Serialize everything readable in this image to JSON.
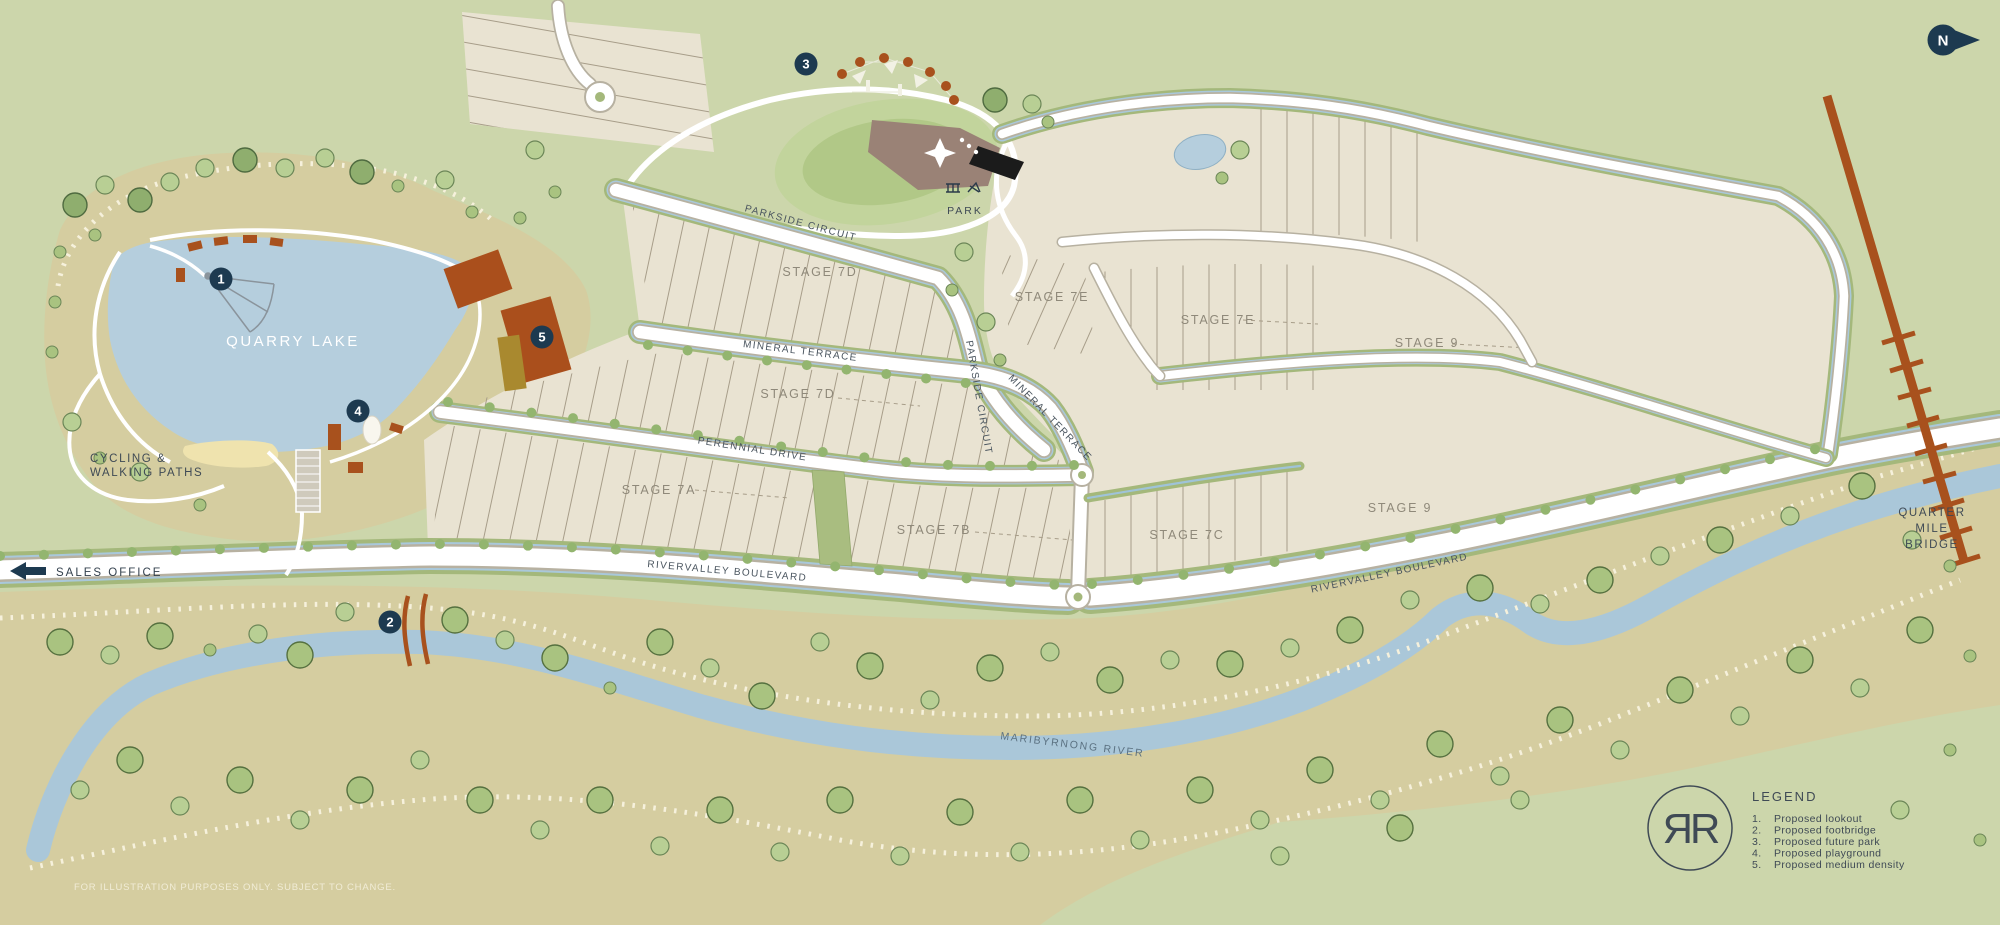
{
  "colors": {
    "background": "#ccd6ab",
    "river_corridor": "#d5cda0",
    "lot_fill": "#e9e3d2",
    "road_white": "#ffffff",
    "road_casing": "#b7b1a1",
    "verge_green": "#a4b87b",
    "water_blue": "#b5cedd",
    "river_blue": "#aac7d9",
    "tree_green": "#a9c380",
    "rust_brown": "#a8511d",
    "marker_navy": "#1d3a50",
    "stage_text": "#8f897a",
    "dark_text": "#3f4a55"
  },
  "north": {
    "label": "N"
  },
  "sales": {
    "label": "SALES OFFICE"
  },
  "lake": {
    "name": "QUARRY LAKE"
  },
  "paths_label": {
    "line1": "CYCLING &",
    "line2": "WALKING PATHS"
  },
  "park": {
    "label": "PARK"
  },
  "river": {
    "name": "MARIBYRNONG RIVER"
  },
  "bridge": {
    "line1": "QUARTER",
    "line2": "MILE",
    "line3": "BRIDGE"
  },
  "streets": {
    "parkside": "PARKSIDE CIRCUIT",
    "parkside_v": "PARKSIDE CIRCUIT",
    "mineral": "MINERAL TERRACE",
    "mineral2": "MINERAL TERRACE",
    "perennial": "PERENNIAL DRIVE",
    "blvd_west": "RIVERVALLEY BOULEVARD",
    "blvd_east": "RIVERVALLEY BOULEVARD"
  },
  "stages": [
    {
      "label": "STAGE 7D"
    },
    {
      "label": "STAGE 7D"
    },
    {
      "label": "STAGE 7A"
    },
    {
      "label": "STAGE 7B"
    },
    {
      "label": "STAGE 7C"
    },
    {
      "label": "STAGE 7E"
    },
    {
      "label": "STAGE 7E"
    },
    {
      "label": "STAGE 9"
    },
    {
      "label": "STAGE 9"
    }
  ],
  "markers": [
    {
      "number": "1"
    },
    {
      "number": "2"
    },
    {
      "number": "3"
    },
    {
      "number": "4"
    },
    {
      "number": "5"
    }
  ],
  "legend": {
    "title": "LEGEND",
    "items": [
      {
        "num": "1.",
        "text": "Proposed lookout"
      },
      {
        "num": "2.",
        "text": "Proposed footbridge"
      },
      {
        "num": "3.",
        "text": "Proposed future park"
      },
      {
        "num": "4.",
        "text": "Proposed playground"
      },
      {
        "num": "5.",
        "text": "Proposed medium density"
      }
    ]
  },
  "logo": {
    "monogram": "ЯR"
  },
  "disclaimer": "FOR ILLUSTRATION PURPOSES ONLY. SUBJECT TO CHANGE."
}
